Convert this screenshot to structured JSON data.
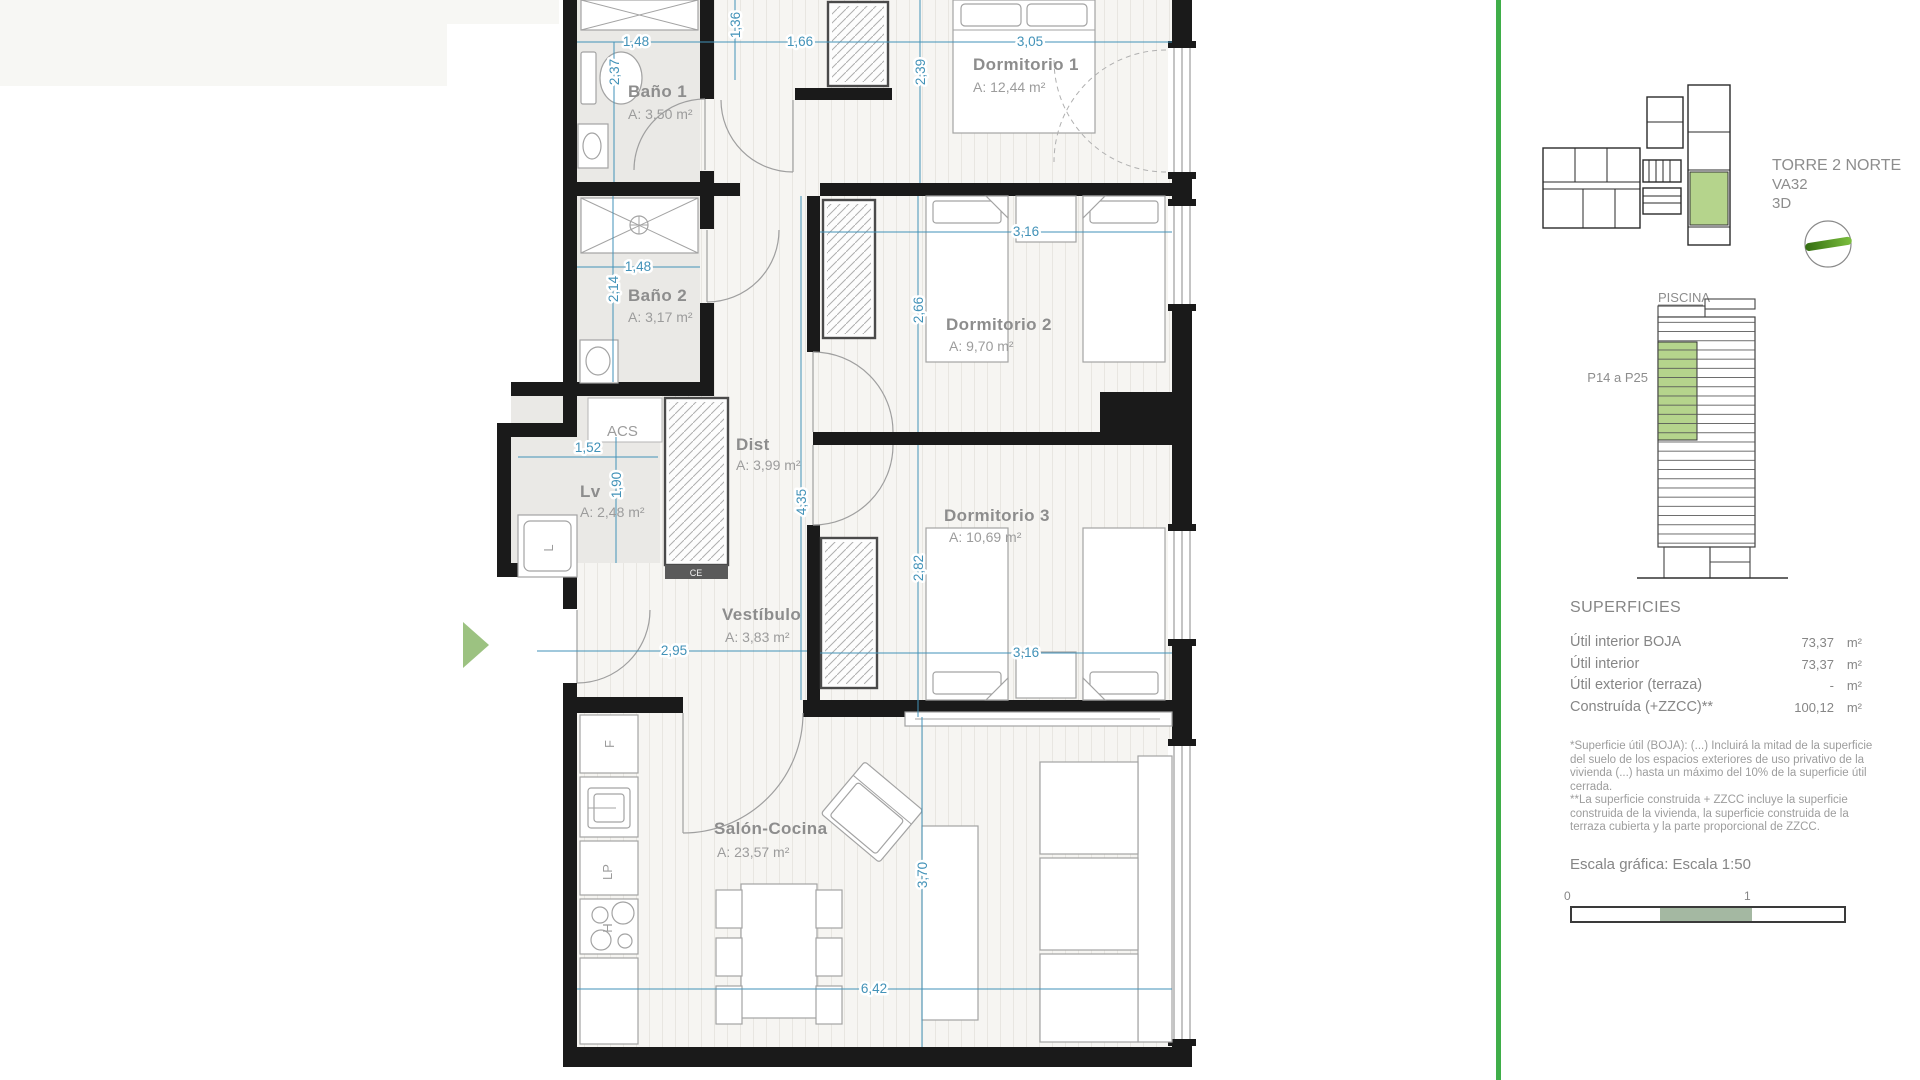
{
  "plan": {
    "rooms": [
      {
        "name": "Baño 1",
        "area": "A: 3,50 m²"
      },
      {
        "name": "Baño 2",
        "area": "A: 3,17 m²"
      },
      {
        "name": "Dormitorio 1",
        "area": "A: 12,44 m²"
      },
      {
        "name": "Dormitorio 2",
        "area": "A: 9,70 m²"
      },
      {
        "name": "Dormitorio 3",
        "area": "A: 10,69 m²"
      },
      {
        "name": "Dist",
        "area": "A: 3,99 m²"
      },
      {
        "name": "Lv",
        "area": "A: 2,48 m²"
      },
      {
        "name": "Vestíbulo",
        "area": "A: 3,83 m²"
      },
      {
        "name": "Salón-Cocina",
        "area": "A: 23,57 m²"
      },
      {
        "name": "ACS",
        "area": ""
      }
    ],
    "labels": {
      "acs": "ACS",
      "washer": "L",
      "fridge": "F",
      "lp": "LP",
      "hob": "H",
      "closet": "CE"
    },
    "dims": {
      "bano1_w": "1,48",
      "bano1_h": "2,37",
      "hall_v": "1,36",
      "hall_w": "1,66",
      "dorm1_w": "3,05",
      "dorm1_h": "2,39",
      "bano2_w": "1,48",
      "bano2_h": "2,14",
      "dorm2_w": "3,16",
      "dorm2_h": "2,66",
      "lv_w": "1,52",
      "lv_h": "1,90",
      "dist_h": "4,35",
      "dorm3_h": "2,82",
      "dorm3_w": "3,16",
      "vest_w": "2,95",
      "salon_w": "6,42",
      "salon_h": "3,70"
    }
  },
  "sidebar": {
    "tower_title": "TORRE 2 NORTE",
    "unit_code": "VA32",
    "view_label": "3D",
    "piscina": "PISCINA",
    "floors_range": "P14 a P25",
    "superficies": {
      "title": "SUPERFICIES",
      "rows": [
        {
          "label": "Útil interior BOJA",
          "value": "73,37",
          "unit": "m²"
        },
        {
          "label": "Útil interior",
          "value": "73,37",
          "unit": "m²"
        },
        {
          "label": "Útil exterior (terraza)",
          "value": "-",
          "unit": "m²"
        },
        {
          "label": "Construída (+ZZCC)**",
          "value": "100,12",
          "unit": "m²"
        }
      ]
    },
    "footnote1": "*Superficie útil (BOJA): (...) Incluirá la mitad de la superficie del suelo de los espacios exteriores de uso privativo de la vivienda (...) hasta un máximo del 10% de la superficie útil cerrada.",
    "footnote2": "**La superficie construida + ZZCC incluye la superficie construida de la vivienda, la superficie construida de la terraza cubierta y la parte proporcional de ZZCC.",
    "scale_title": "Escala gráfica: Escala 1:50",
    "scale_start": "0",
    "scale_end": "1"
  },
  "colors": {
    "wall": "#1a1a1a",
    "dim_blue": "#4292b8",
    "label_grey": "#8d8d8d",
    "accent_green": "#3fae49",
    "unit_green": "#b5d48c",
    "entrance_green": "#9cc281",
    "scale_green": "#a4b8a2"
  }
}
